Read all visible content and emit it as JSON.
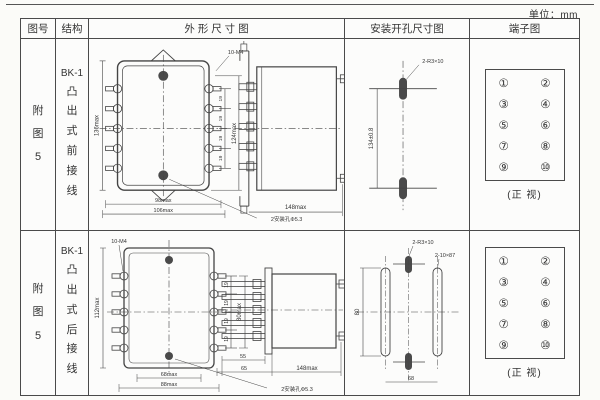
{
  "unit_label": "单位：mm",
  "headers": {
    "fig": "图号",
    "structure": "结构",
    "outline": "外 形 尺 寸 图",
    "mounting": "安装开孔尺寸图",
    "terminal": "端子图"
  },
  "rows": [
    {
      "fig_no": "附图5",
      "model": "BK-1",
      "structure": "凸出式前接线",
      "outline": {
        "h_left": "136max",
        "h_right": "124max",
        "pitch": [
          "19",
          "19",
          "19",
          "19"
        ],
        "screw": "10-M4",
        "w_inner": "98max",
        "w_outer": "106max",
        "hole_note": "2安装孔Φ5.3",
        "side_width": "148max"
      },
      "mounting": {
        "slot": "2-R3×10",
        "v_dim": "134±0.8"
      },
      "terminal": {
        "left": [
          "①",
          "③",
          "⑤",
          "⑦",
          "⑨"
        ],
        "right": [
          "②",
          "④",
          "⑥",
          "⑧",
          "⑩"
        ],
        "caption": "(正 视)"
      }
    },
    {
      "fig_no": "附图5",
      "model": "BK-1",
      "structure": "凸出式后接线",
      "outline": {
        "h_left": "112max",
        "h_right": "80max",
        "pitch": [
          "19",
          "19",
          "19",
          "19"
        ],
        "screw": "10-M4",
        "w_inner": "68max",
        "w_outer": "88max",
        "hole_note": "2安装孔Φ5.3",
        "stud_len": "55",
        "stud_total": "65",
        "side_width": "148max"
      },
      "mounting": {
        "slot_small": "2-R3×10",
        "slot_long": "2-10×87",
        "v_dim": "80",
        "h_dim": "68"
      },
      "terminal": {
        "left": [
          "①",
          "③",
          "⑤",
          "⑦",
          "⑨"
        ],
        "right": [
          "②",
          "④",
          "⑥",
          "⑧",
          "⑩"
        ],
        "caption": "(正 视)"
      }
    }
  ]
}
